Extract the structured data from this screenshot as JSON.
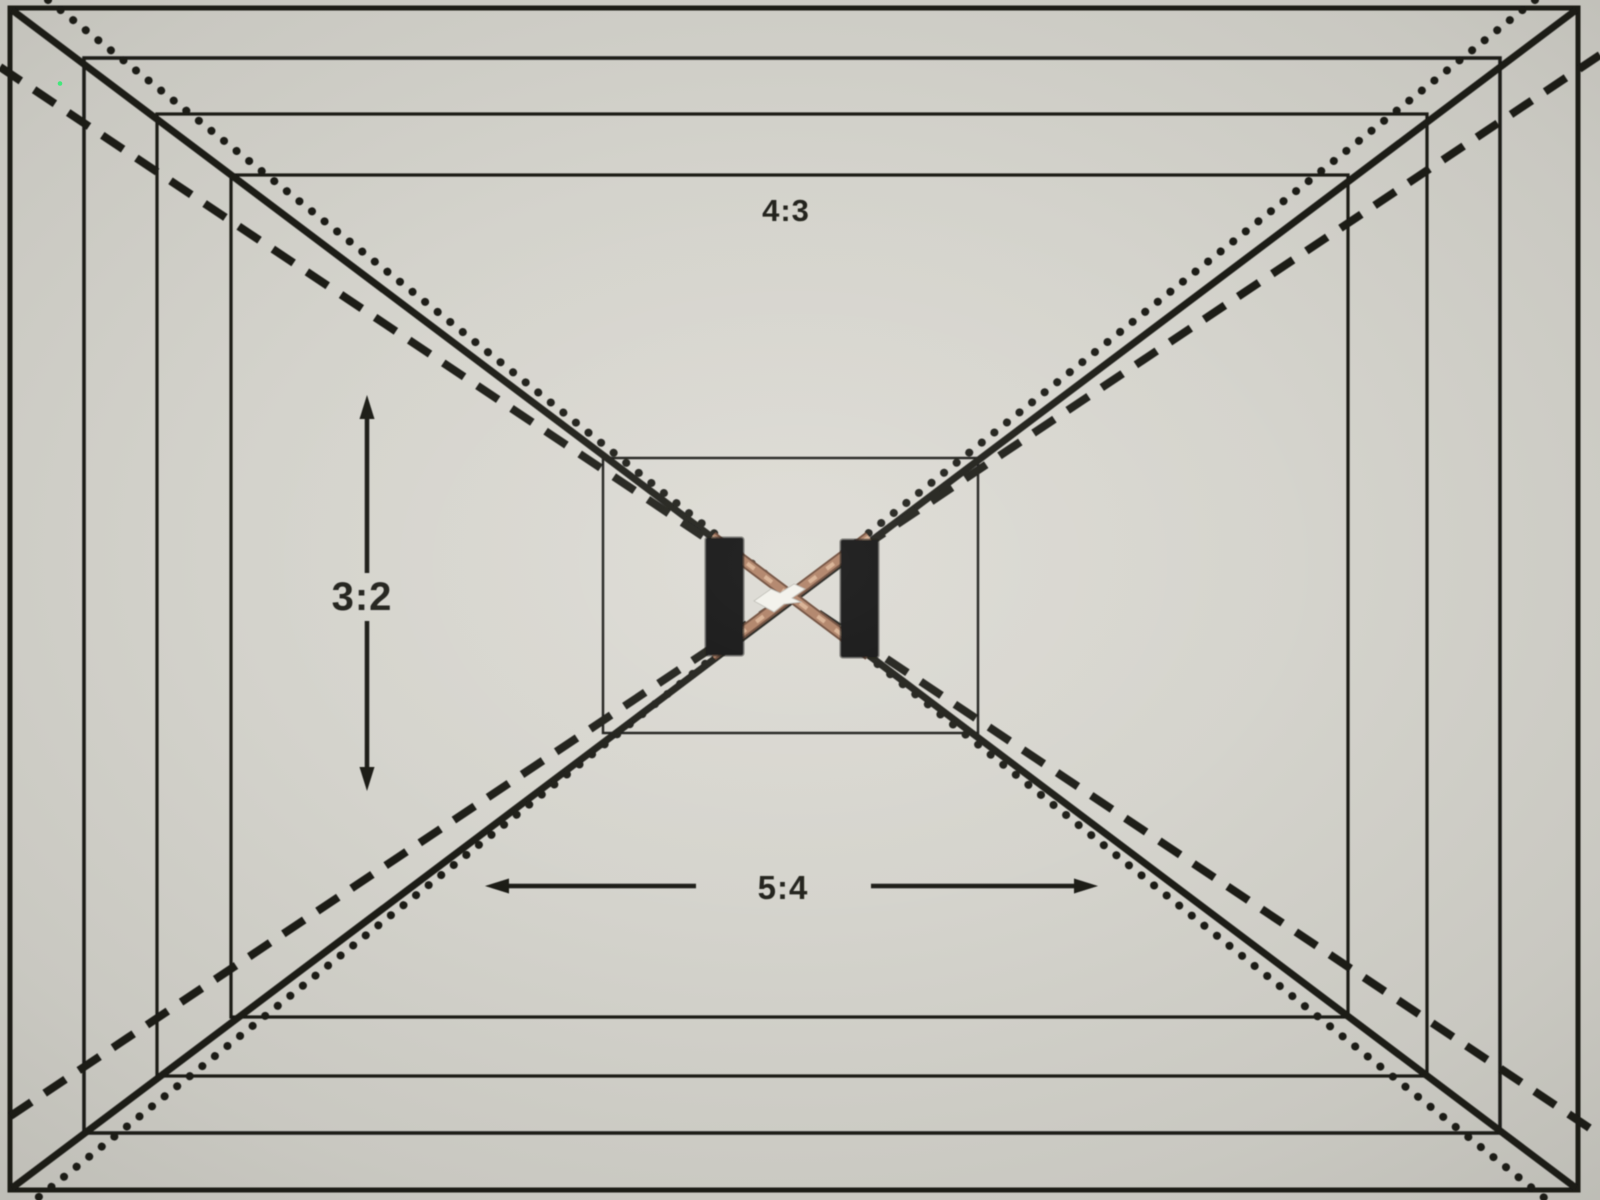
{
  "scene": {
    "description": "Photograph of a printed aspect-ratio framing test chart with nested 4:3 frames, corner-to-center diagonals in three line styles, two black bars and a shiny copper X with a white foil marker at the center",
    "vignette": "bright center, dark corners"
  },
  "labels": {
    "top_aspect": "4:3",
    "left_aspect": "3:2",
    "bottom_aspect": "5:4"
  },
  "chart": {
    "type": "framing-test-chart",
    "nested_43_frames": 5,
    "aspect_marks": [
      {
        "label": "4:3",
        "line_style": "solid",
        "indicator": "text at top center"
      },
      {
        "label": "3:2",
        "line_style": "dashed",
        "indicator": "vertical double-headed arrow left of center"
      },
      {
        "label": "5:4",
        "line_style": "dotted",
        "indicator": "horizontal double-headed arrow below center"
      }
    ],
    "center_features": [
      "two black vertical bars flanking center",
      "copper-colored diagonal strips forming an X",
      "white foil marker at exact center"
    ],
    "artifacts": {
      "green_pixel_dot": {
        "x": 60,
        "y": 83
      }
    }
  },
  "colors": {
    "paper_center": "#d9d7d0",
    "paper_edge": "#8e8d88",
    "ink": "#1a1a17",
    "copper": "#ad7e62",
    "copper_highlight": "#d7ae8f",
    "bar_black": "#0e0e0c",
    "marker_white": "#f2f1ea",
    "artifact_green": "#42e87b"
  }
}
